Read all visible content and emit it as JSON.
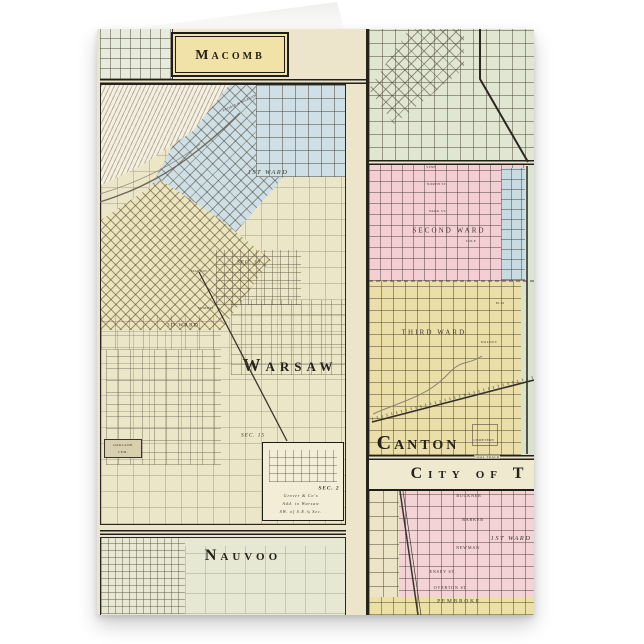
{
  "titles": {
    "macomb": "Macomb",
    "warsaw": "Warsaw",
    "canton": "Canton",
    "city_of_t": "City of T",
    "nauvoo": "Nauvoo"
  },
  "warsaw_labels": {
    "first_ward": "1st Ward",
    "railroad": "Peoria & Warsaw",
    "sec10": "Sec. 10",
    "marion": "Marion",
    "summit": "Summit",
    "third_ward": "3d Ward",
    "sec15": "Sec. 15",
    "oakland_line1": "Oakland",
    "oakland_line2": "Cem.",
    "inset_sec2": "Sec. 2",
    "inset_line1": "Grover & Co's",
    "inset_line2": "Add. to Warsaw",
    "inset_line3": "SW. of S.E.¼ Sec."
  },
  "canton_labels": {
    "vine": "Vine",
    "north_st": "North St.",
    "park_st": "Park St.",
    "cole": "Cole",
    "second_ward": "Second Ward",
    "third_ward": "Third Ward",
    "elm": "Elm",
    "walnut": "Walnut",
    "cemetery": "Cemetery",
    "coal_track": "Coal Track"
  },
  "city_t_labels": {
    "buckner": "Buckner",
    "barker": "Barker",
    "first_ward": "1st Ward",
    "newman": "Newman",
    "ensey": "Ensey St.",
    "overton": "Overton St.",
    "pembroke": "Pembroke"
  },
  "colors": {
    "card_base": "#ece5cb",
    "banner_yellow": "#f1e2a8",
    "ward_blue": "#cdduse-e6",
    "ward_blue_hex": "#cddee6",
    "ward_pink": "#f3ced3",
    "ward_yellow": "#ebdfa9",
    "map_green": "#e0e6d2",
    "nauvoo_green": "#e6e8d3",
    "ink": "#2e2a22"
  }
}
